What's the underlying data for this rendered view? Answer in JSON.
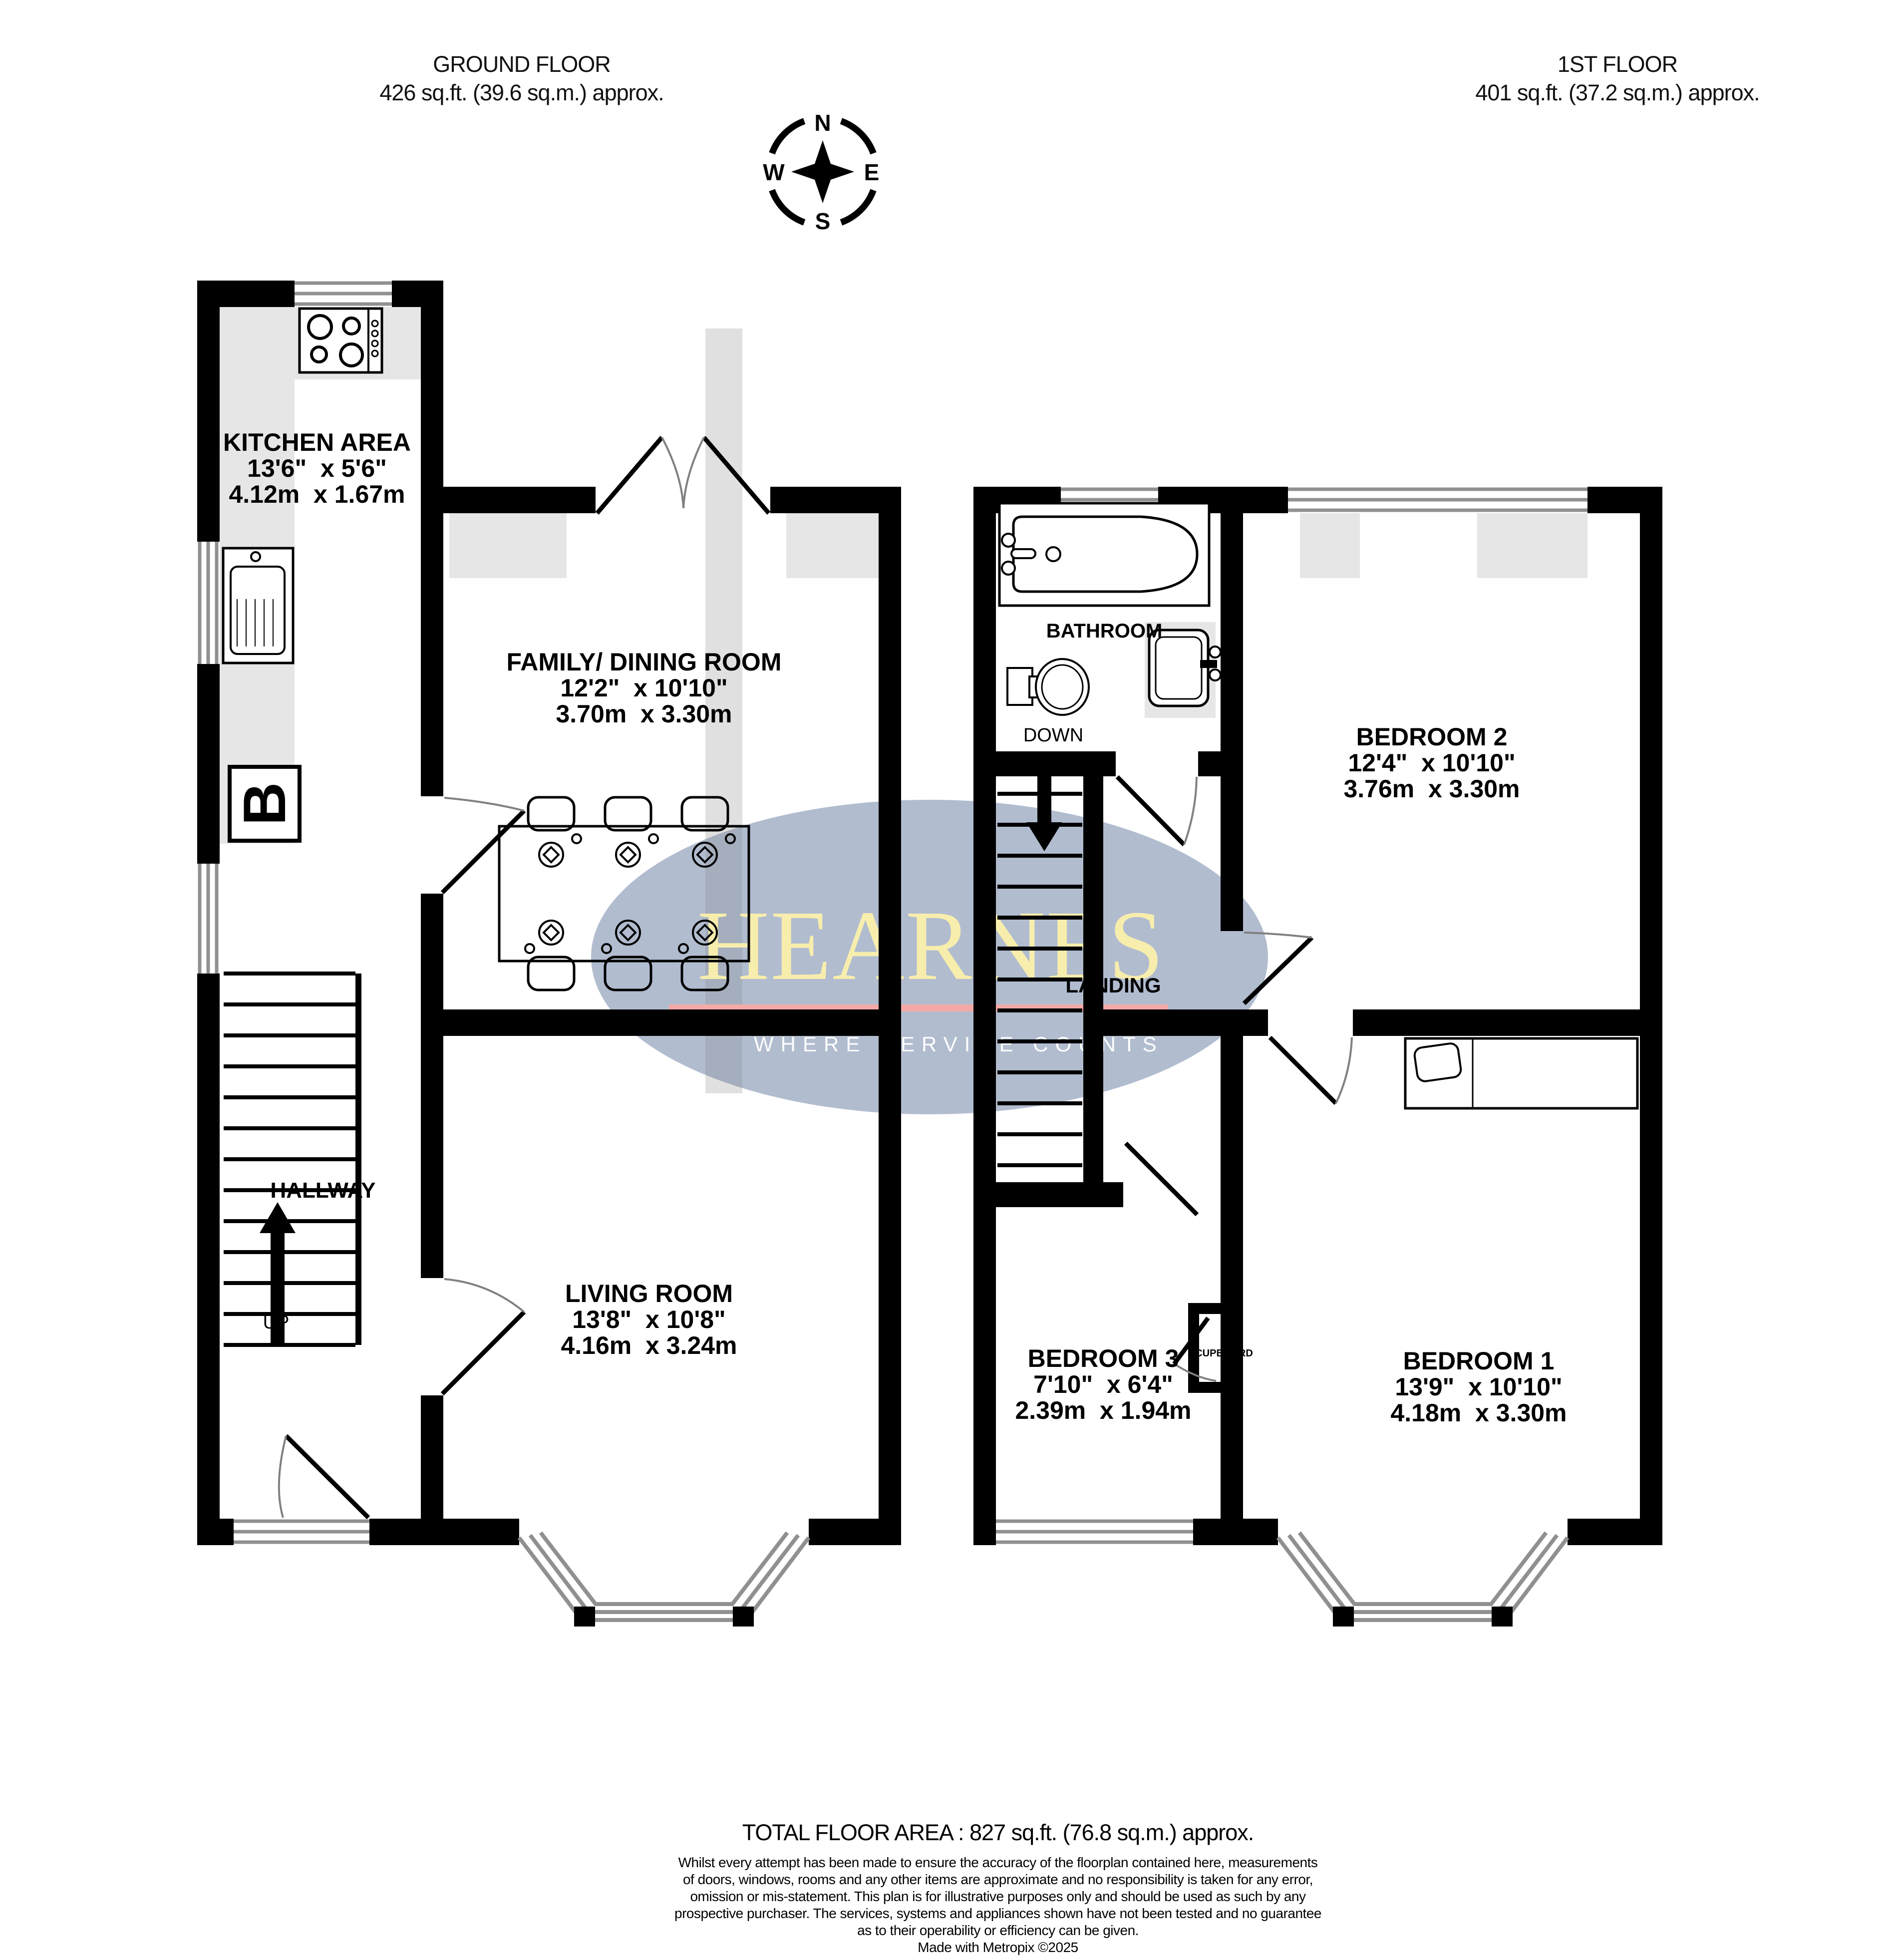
{
  "header": {
    "ground_floor": {
      "title": "GROUND FLOOR",
      "area": "426 sq.ft. (39.6 sq.m.) approx."
    },
    "first_floor": {
      "title": "1ST FLOOR",
      "area": "401 sq.ft. (37.2 sq.m.) approx."
    }
  },
  "compass": {
    "n": "N",
    "e": "E",
    "s": "S",
    "w": "W"
  },
  "rooms": {
    "kitchen": {
      "name": "KITCHEN AREA",
      "imperial": "13'6\"  x 5'6\"",
      "metric": "4.12m  x 1.67m"
    },
    "family": {
      "name": "FAMILY/ DINING ROOM",
      "imperial": "12'2\"  x 10'10\"",
      "metric": "3.70m  x 3.30m"
    },
    "living": {
      "name": "LIVING ROOM",
      "imperial": "13'8\"  x 10'8\"",
      "metric": "4.16m  x 3.24m"
    },
    "hallway": {
      "name": "HALLWAY"
    },
    "bathroom": {
      "name": "BATHROOM"
    },
    "landing": {
      "name": "LANDING"
    },
    "cupboard": {
      "name": "CUPBOARD"
    },
    "bedroom1": {
      "name": "BEDROOM 1",
      "imperial": "13'9\"  x 10'10\"",
      "metric": "4.18m  x 3.30m"
    },
    "bedroom2": {
      "name": "BEDROOM 2",
      "imperial": "12'4\"  x 10'10\"",
      "metric": "3.76m  x 3.30m"
    },
    "bedroom3": {
      "name": "BEDROOM 3",
      "imperial": "7'10\"  x 6'4\"",
      "metric": "2.39m  x 1.94m"
    }
  },
  "stairs": {
    "up": "UP",
    "down": "DOWN"
  },
  "boiler_label": "B",
  "watermark": {
    "brand": "HEARNES",
    "tagline": "WHERE SERVICE COUNTS",
    "ellipse_color": "#b1bccf",
    "brand_color": "#f7edad",
    "line_color": "#f5a9a7",
    "tagline_color": "#fdfdfd"
  },
  "footer": {
    "total": "TOTAL FLOOR AREA : 827 sq.ft. (76.8 sq.m.) approx.",
    "disclaimer_lines": [
      "Whilst every attempt has been made to ensure the accuracy of the floorplan contained here, measurements",
      "of doors, windows, rooms and any other items are approximate and no responsibility is taken for any error,",
      "omission or mis-statement. This plan is for illustrative purposes only and should be used as such by any",
      "prospective purchaser. The services, systems and appliances shown have not been tested and no guarantee",
      "as to their operability or efficiency can be given.",
      "Made with Metropix ©2025"
    ]
  },
  "colors": {
    "wall": "#000000",
    "window_shading": "#e6e6e6",
    "window_line": "#909090"
  },
  "icons": {
    "compass": "compass-rose",
    "stove": "stove-hob-icon",
    "sink": "kitchen-sink-icon",
    "boiler": "boiler-icon",
    "bath": "bathtub-icon",
    "toilet": "toilet-icon",
    "basin": "wash-basin-icon",
    "bed": "single-bed-icon",
    "table": "dining-table-icon"
  }
}
